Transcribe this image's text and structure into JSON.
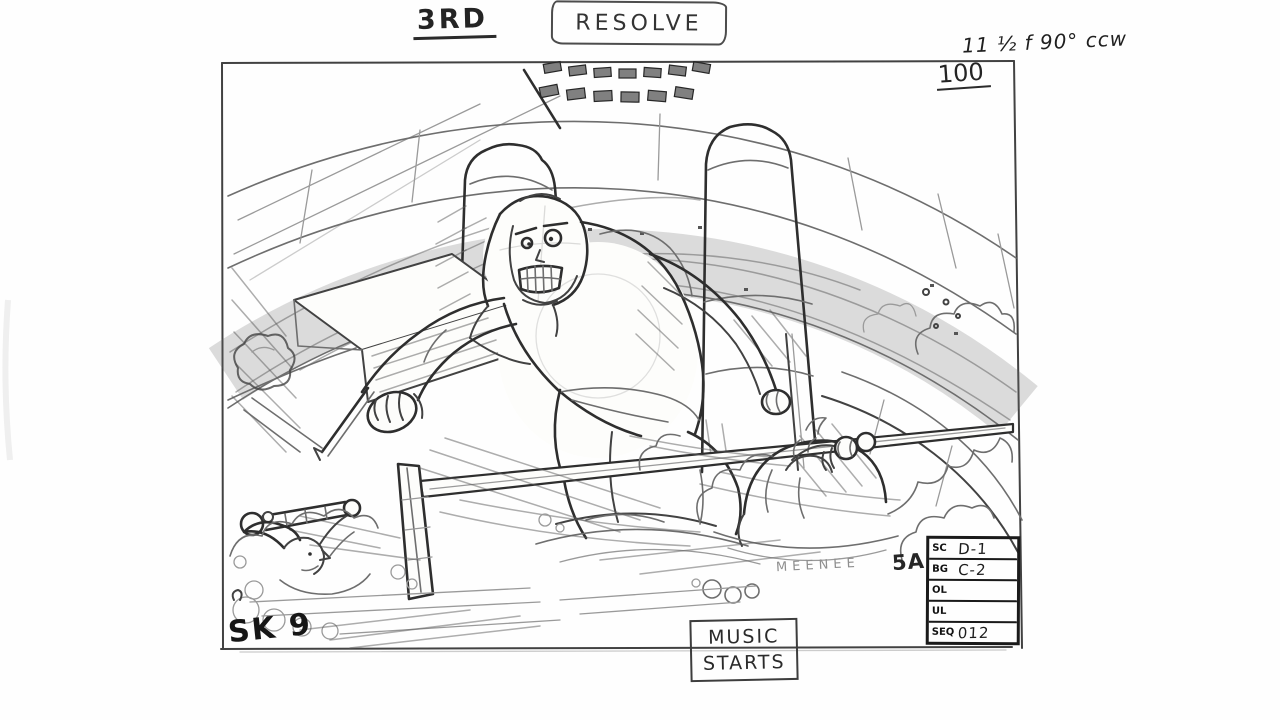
{
  "header": {
    "sequence_label": "3RD",
    "action_label": "RESOLVE",
    "camera_note": "11 ½ f 90° ccw"
  },
  "panel": {
    "frame_count": "100",
    "sketch_number": "SK 9",
    "panel_code": "5A",
    "character_name": "MEENEE"
  },
  "music_cue": {
    "line1": "MUSIC",
    "line2": "STARTS"
  },
  "slate": {
    "rows": [
      {
        "label": "SC",
        "value": "D-1"
      },
      {
        "label": "BG",
        "value": "C-2"
      },
      {
        "label": "OL",
        "value": ""
      },
      {
        "label": "UL",
        "value": ""
      },
      {
        "label": "SEQ",
        "value": "012"
      }
    ]
  },
  "colors": {
    "pencil_dark": "#2e2e2e",
    "pencil_mid": "#5c5c5c",
    "pencil_light": "#9a9a9a",
    "paper": "#fdfdfb"
  }
}
